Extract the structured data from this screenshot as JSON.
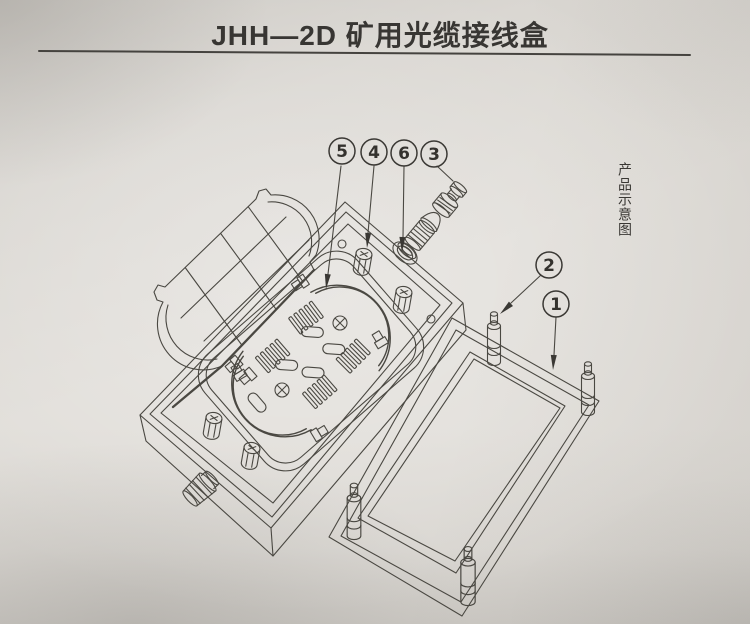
{
  "page": {
    "title": "JHH—2D 矿用光缆接线盒",
    "side_label": "产品示意图"
  },
  "callouts": [
    {
      "number": "5"
    },
    {
      "number": "4"
    },
    {
      "number": "6"
    },
    {
      "number": "3"
    },
    {
      "number": "2"
    },
    {
      "number": "1"
    }
  ],
  "colors": {
    "paper": "#e0ddd8",
    "ink_line": "#4a4842",
    "text": "#3a3834"
  }
}
